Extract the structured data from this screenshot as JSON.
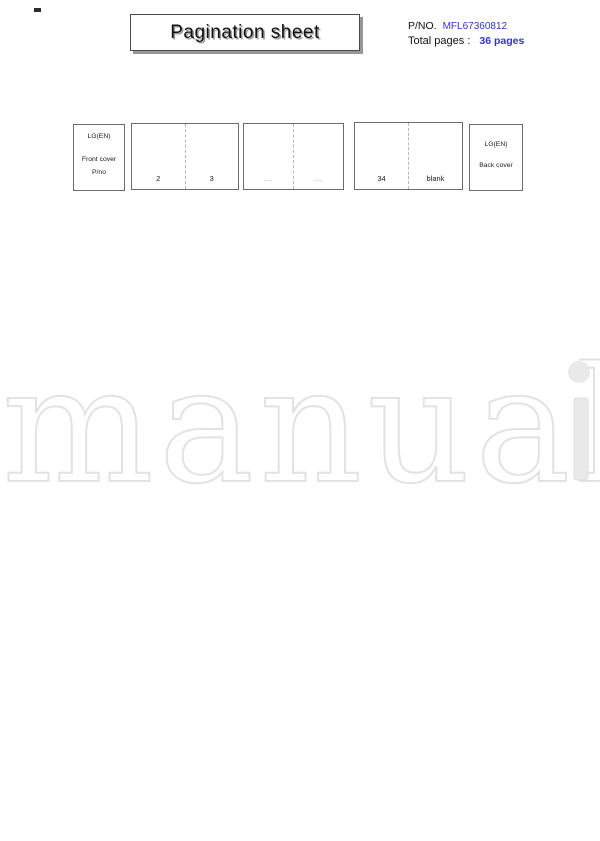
{
  "header": {
    "title": "Pagination sheet",
    "pno_label": "P/NO.",
    "pno_value": "MFL67360812",
    "total_pages_label": "Total pages :",
    "total_pages_value": "36 pages",
    "accent_color": "#3333cc"
  },
  "pagination_row": {
    "front_cover": {
      "line1": "LG(EN)",
      "line2": "Front cover",
      "line3": "P/no"
    },
    "spreads": [
      {
        "left": "2",
        "right": "3"
      },
      {
        "left": "...",
        "right": "..."
      },
      {
        "left": "34",
        "right": "blank"
      }
    ],
    "back_cover": {
      "line1": "LG(EN)",
      "line2": "Back cover"
    }
  },
  "watermark": {
    "outline_text": "manual",
    "filled_letter": "i",
    "outline_color": "#e2e2e2",
    "fill_color": "#e9e9e9"
  }
}
